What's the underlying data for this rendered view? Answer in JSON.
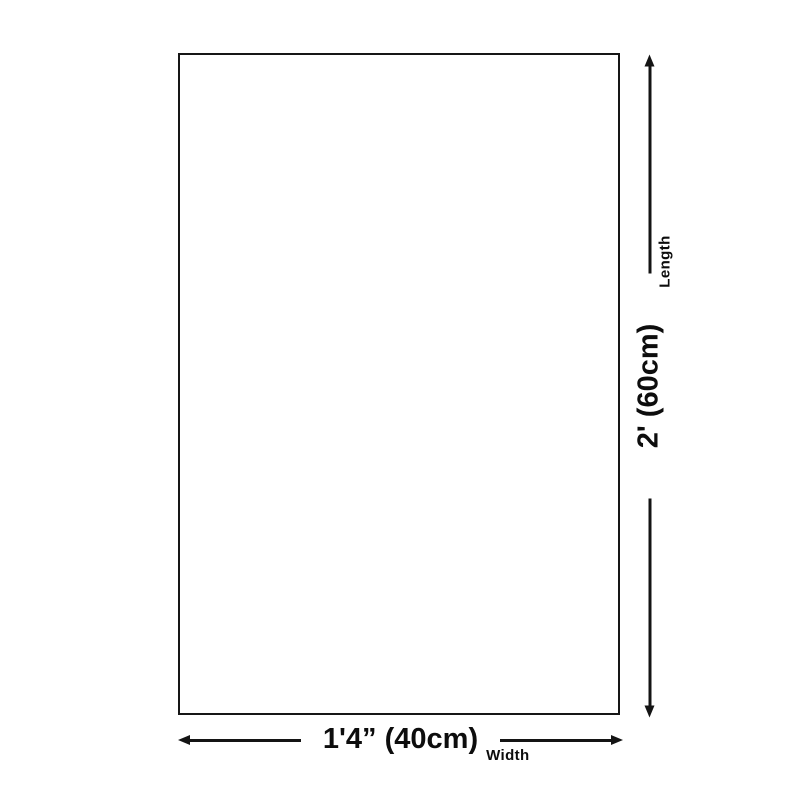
{
  "diagram": {
    "title": "product-dimension-diagram",
    "product_box": {
      "shape": "rectangle",
      "fill": "#ffffff",
      "border_color": "#161616"
    },
    "width_dimension": {
      "label": "Width",
      "value": "1'4” (40cm)",
      "orientation": "horizontal",
      "arrow": "double-headed"
    },
    "length_dimension": {
      "label": "Length",
      "value": "2' (60cm)",
      "orientation": "vertical",
      "arrow": "double-headed"
    },
    "colors": {
      "background": "#ffffff",
      "line": "#141414",
      "text": "#0d0d0d"
    }
  }
}
